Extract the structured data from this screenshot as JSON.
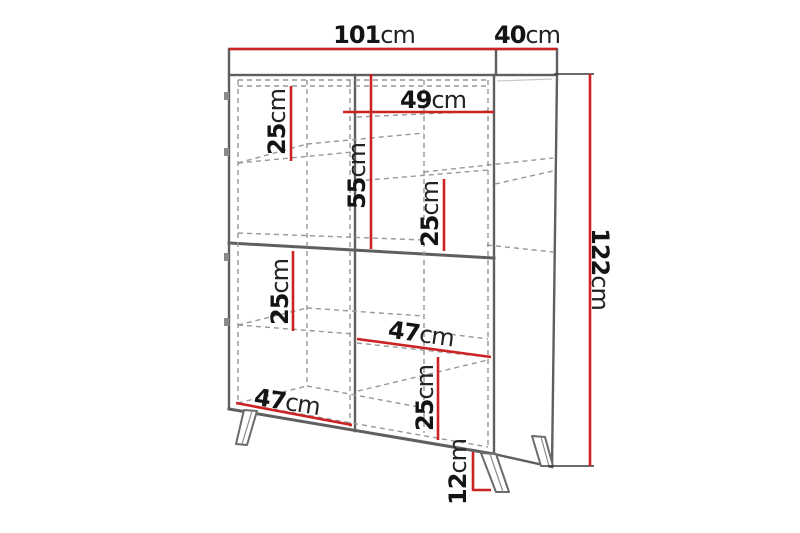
{
  "colors": {
    "dimension_line": "#cc2222",
    "outline": "#5f5f5f",
    "dashed": "#979797",
    "background": "#ffffff",
    "text": "#141414"
  },
  "dimensions": {
    "top_width": {
      "value": "101",
      "unit": "cm"
    },
    "top_depth": {
      "value": "40",
      "unit": "cm"
    },
    "total_height": {
      "value": "122",
      "unit": "cm"
    },
    "upper_left_shelf": {
      "value": "25",
      "unit": "cm"
    },
    "upper_right_width": {
      "value": "49",
      "unit": "cm"
    },
    "upper_section_height": {
      "value": "55",
      "unit": "cm"
    },
    "upper_right_shelf": {
      "value": "25",
      "unit": "cm"
    },
    "lower_left_shelf": {
      "value": "25",
      "unit": "cm"
    },
    "lower_right_width": {
      "value": "47",
      "unit": "cm"
    },
    "lower_right_shelf": {
      "value": "25",
      "unit": "cm"
    },
    "bottom_left_width": {
      "value": "47",
      "unit": "cm"
    },
    "leg_height": {
      "value": "12",
      "unit": "cm"
    }
  }
}
